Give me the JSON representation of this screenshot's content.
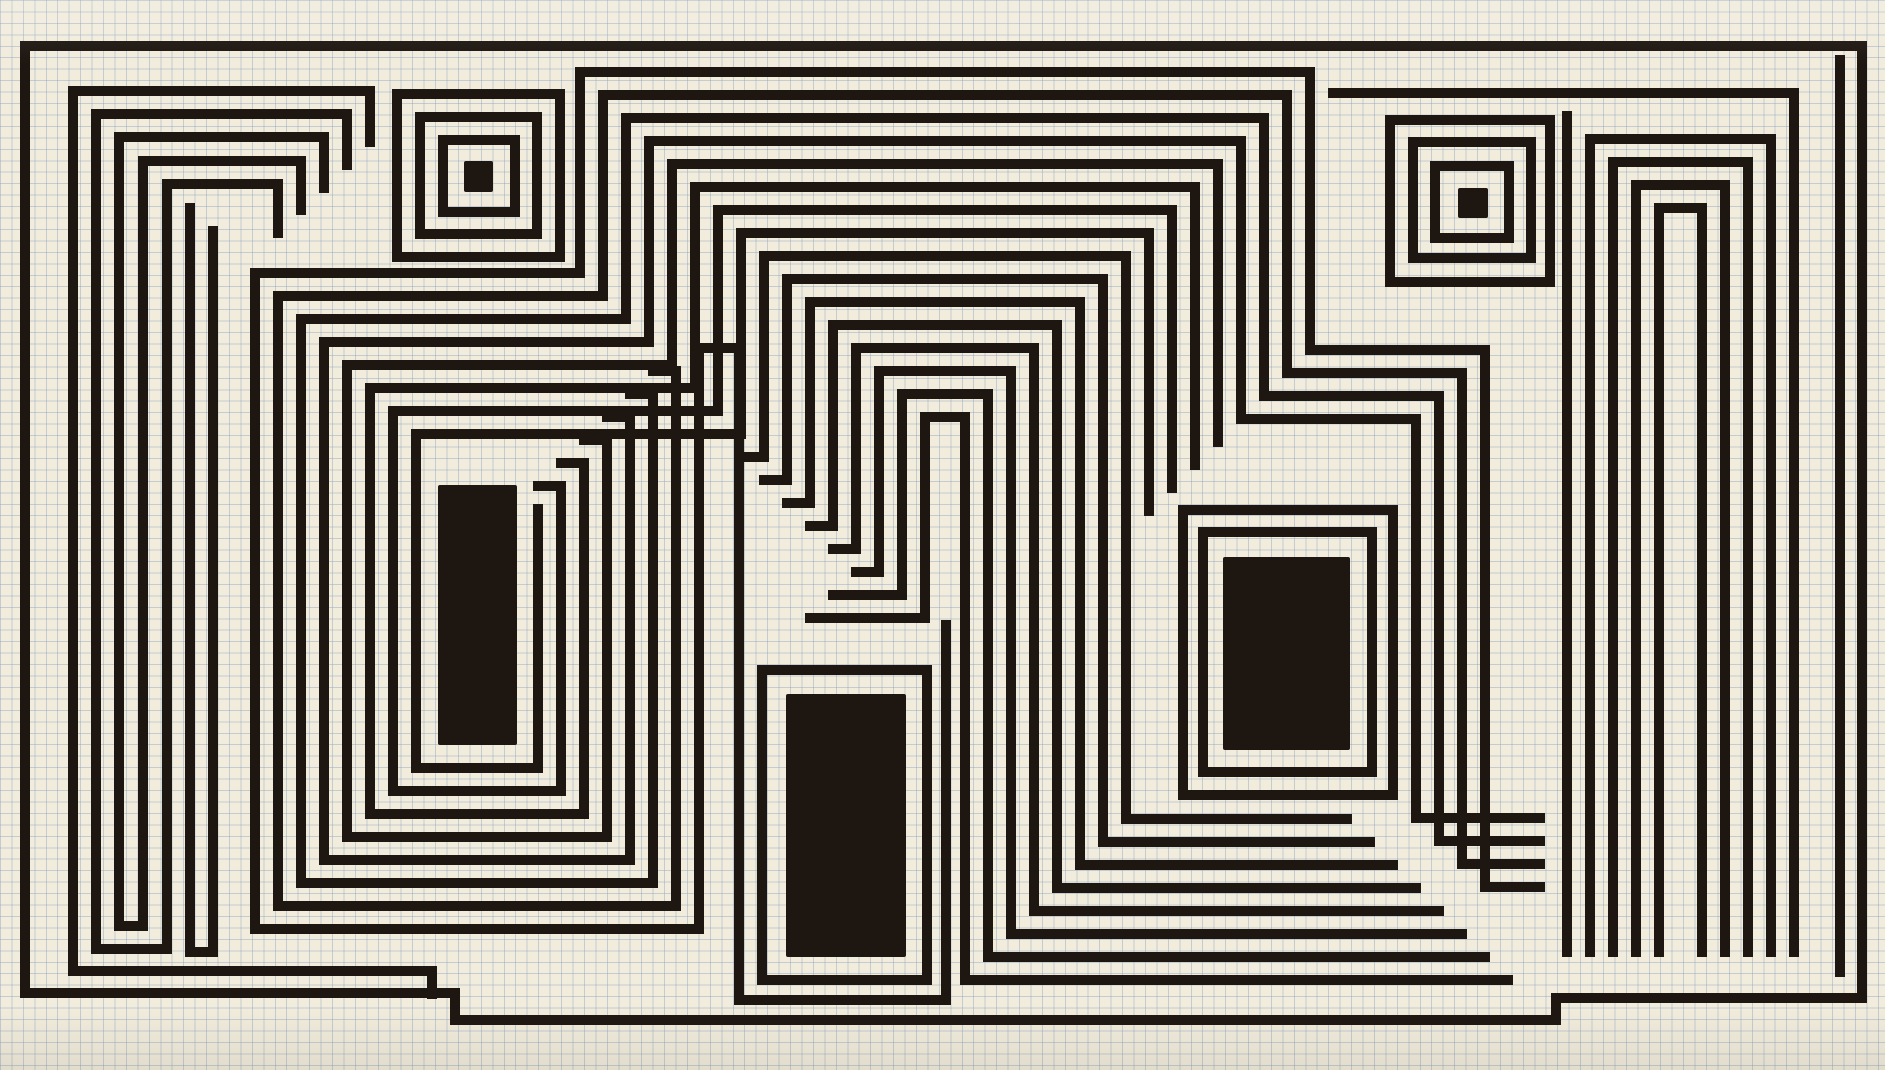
{
  "artwork": {
    "kind": "ink-labyrinth-drawing-on-graph-paper",
    "canvas": {
      "width": 1885,
      "height": 1070
    },
    "colors": {
      "paper": "#f1ecdc",
      "paper_edge": "#e3dcc9",
      "grid": "rgba(130,156,190,0.40)",
      "ink": "#1e1711"
    },
    "grid": {
      "cell": 11.45,
      "line": 1
    },
    "stroke_width": 10,
    "fills": [
      {
        "name": "left-black-rectangle",
        "x": 438,
        "y": 485,
        "w": 79,
        "h": 260
      },
      {
        "name": "center-black-rectangle",
        "x": 786,
        "y": 694,
        "w": 120,
        "h": 263
      },
      {
        "name": "right-black-rectangle",
        "x": 1223,
        "y": 557,
        "w": 127,
        "h": 193
      },
      {
        "name": "left-bullseye-core",
        "x": 464,
        "y": 161,
        "w": 29,
        "h": 31
      },
      {
        "name": "right-bullseye-core",
        "x": 1458,
        "y": 188,
        "w": 30,
        "h": 30
      }
    ],
    "rings": [
      {
        "name": "left-bullseye-ring-1",
        "x": 443,
        "y": 140,
        "w": 72,
        "h": 72
      },
      {
        "name": "left-bullseye-ring-2",
        "x": 420,
        "y": 117,
        "w": 117,
        "h": 117
      },
      {
        "name": "left-bullseye-ring-3",
        "x": 397,
        "y": 94,
        "w": 163,
        "h": 163
      },
      {
        "name": "right-bullseye-ring-1",
        "x": 1435,
        "y": 166,
        "w": 74,
        "h": 72
      },
      {
        "name": "right-bullseye-ring-2",
        "x": 1413,
        "y": 142,
        "w": 118,
        "h": 116
      },
      {
        "name": "right-bullseye-ring-3",
        "x": 1390,
        "y": 120,
        "w": 160,
        "h": 162
      },
      {
        "name": "center-rect-frame",
        "x": 762,
        "y": 670,
        "w": 165,
        "h": 310
      },
      {
        "name": "right-rect-frame-1",
        "x": 1203,
        "y": 532,
        "w": 169,
        "h": 240
      },
      {
        "name": "right-rect-frame-2",
        "x": 1183,
        "y": 510,
        "w": 210,
        "h": 285
      }
    ],
    "polylines": [
      {
        "name": "outer-border",
        "pts": [
          [
            25,
            46
          ],
          [
            1862,
            46
          ],
          [
            1862,
            998
          ],
          [
            1556,
            998
          ],
          [
            1556,
            1020
          ],
          [
            455,
            1020
          ],
          [
            455,
            993
          ],
          [
            25,
            993
          ],
          [
            25,
            46
          ]
        ]
      },
      {
        "name": "border-inner-right",
        "pts": [
          [
            1840,
            60
          ],
          [
            1840,
            972
          ]
        ]
      },
      {
        "name": "fan-line-1",
        "pts": [
          [
            370,
            142
          ],
          [
            370,
            91
          ],
          [
            73,
            91
          ],
          [
            73,
            971
          ],
          [
            432,
            971
          ],
          [
            432,
            994
          ]
        ]
      },
      {
        "name": "fan-line-2",
        "pts": [
          [
            347,
            165
          ],
          [
            347,
            114
          ],
          [
            96,
            114
          ],
          [
            96,
            949
          ],
          [
            167,
            949
          ],
          [
            167,
            184
          ],
          [
            278,
            184
          ],
          [
            278,
            233
          ]
        ]
      },
      {
        "name": "fan-line-3",
        "pts": [
          [
            324,
            188
          ],
          [
            324,
            137
          ],
          [
            119,
            137
          ],
          [
            119,
            926
          ],
          [
            143,
            926
          ],
          [
            143,
            161
          ],
          [
            301,
            161
          ],
          [
            301,
            210
          ]
        ]
      },
      {
        "name": "left-tall-u",
        "pts": [
          [
            190,
            208
          ],
          [
            190,
            952
          ],
          [
            213,
            952
          ],
          [
            213,
            231
          ]
        ]
      },
      {
        "name": "spiral-line-0",
        "pts": [
          [
            1540,
            887
          ],
          [
            1485,
            887
          ],
          [
            1485,
            350
          ],
          [
            1310,
            350
          ],
          [
            1310,
            72
          ],
          [
            580,
            72
          ],
          [
            580,
            273
          ],
          [
            255,
            273
          ],
          [
            255,
            929
          ],
          [
            699,
            929
          ],
          [
            699,
            348
          ],
          [
            739,
            348
          ],
          [
            739,
            1000
          ],
          [
            946,
            1000
          ],
          [
            946,
            625
          ]
        ]
      },
      {
        "name": "spiral-line-1",
        "pts": [
          [
            1540,
            864
          ],
          [
            1462,
            864
          ],
          [
            1462,
            373
          ],
          [
            1287,
            373
          ],
          [
            1287,
            95
          ],
          [
            603,
            95
          ],
          [
            603,
            296
          ],
          [
            278,
            296
          ],
          [
            278,
            906
          ],
          [
            676,
            906
          ],
          [
            676,
            371
          ],
          [
            653,
            371
          ]
        ]
      },
      {
        "name": "spiral-line-2",
        "pts": [
          [
            1540,
            841
          ],
          [
            1439,
            841
          ],
          [
            1439,
            396
          ],
          [
            1264,
            396
          ],
          [
            1264,
            118
          ],
          [
            626,
            118
          ],
          [
            626,
            319
          ],
          [
            301,
            319
          ],
          [
            301,
            883
          ],
          [
            653,
            883
          ],
          [
            653,
            394
          ],
          [
            630,
            394
          ]
        ]
      },
      {
        "name": "spiral-line-3",
        "pts": [
          [
            1540,
            818
          ],
          [
            1416,
            818
          ],
          [
            1416,
            419
          ],
          [
            1241,
            419
          ],
          [
            1241,
            141
          ],
          [
            649,
            141
          ],
          [
            649,
            342
          ],
          [
            324,
            342
          ],
          [
            324,
            860
          ],
          [
            630,
            860
          ],
          [
            630,
            417
          ],
          [
            607,
            417
          ]
        ]
      },
      {
        "name": "spiral-line-4",
        "pts": [
          [
            1218,
            442
          ],
          [
            1218,
            164
          ],
          [
            672,
            164
          ],
          [
            672,
            365
          ],
          [
            347,
            365
          ],
          [
            347,
            837
          ],
          [
            607,
            837
          ],
          [
            607,
            440
          ],
          [
            584,
            440
          ]
        ]
      },
      {
        "name": "spiral-line-5",
        "pts": [
          [
            1195,
            465
          ],
          [
            1195,
            187
          ],
          [
            695,
            187
          ],
          [
            695,
            388
          ],
          [
            370,
            388
          ],
          [
            370,
            814
          ],
          [
            584,
            814
          ],
          [
            584,
            463
          ],
          [
            561,
            463
          ]
        ]
      },
      {
        "name": "spiral-line-6",
        "pts": [
          [
            1172,
            488
          ],
          [
            1172,
            210
          ],
          [
            718,
            210
          ],
          [
            718,
            411
          ],
          [
            393,
            411
          ],
          [
            393,
            791
          ],
          [
            561,
            791
          ],
          [
            561,
            486
          ],
          [
            538,
            486
          ]
        ]
      },
      {
        "name": "spiral-line-7",
        "pts": [
          [
            1149,
            511
          ],
          [
            1149,
            233
          ],
          [
            741,
            233
          ],
          [
            741,
            434
          ],
          [
            416,
            434
          ],
          [
            416,
            768
          ],
          [
            538,
            768
          ],
          [
            538,
            509
          ]
        ]
      },
      {
        "name": "spiral-line-8",
        "pts": [
          [
            1347,
            819
          ],
          [
            1126,
            819
          ],
          [
            1126,
            256
          ],
          [
            764,
            256
          ],
          [
            764,
            457
          ],
          [
            741,
            457
          ]
        ]
      },
      {
        "name": "spiral-line-9",
        "pts": [
          [
            1370,
            842
          ],
          [
            1103,
            842
          ],
          [
            1103,
            279
          ],
          [
            787,
            279
          ],
          [
            787,
            480
          ],
          [
            764,
            480
          ]
        ]
      },
      {
        "name": "spiral-line-10",
        "pts": [
          [
            1393,
            865
          ],
          [
            1080,
            865
          ],
          [
            1080,
            302
          ],
          [
            810,
            302
          ],
          [
            810,
            503
          ],
          [
            787,
            503
          ]
        ]
      },
      {
        "name": "spiral-line-11",
        "pts": [
          [
            1416,
            888
          ],
          [
            1057,
            888
          ],
          [
            1057,
            325
          ],
          [
            833,
            325
          ],
          [
            833,
            526
          ],
          [
            810,
            526
          ]
        ]
      },
      {
        "name": "spiral-line-12",
        "pts": [
          [
            1439,
            911
          ],
          [
            1034,
            911
          ],
          [
            1034,
            348
          ],
          [
            856,
            348
          ],
          [
            856,
            549
          ],
          [
            833,
            549
          ]
        ]
      },
      {
        "name": "center-hairpin-1",
        "pts": [
          [
            1462,
            934
          ],
          [
            1011,
            934
          ],
          [
            1011,
            371
          ],
          [
            879,
            371
          ],
          [
            879,
            572
          ],
          [
            856,
            572
          ]
        ]
      },
      {
        "name": "center-hairpin-2",
        "pts": [
          [
            1485,
            957
          ],
          [
            988,
            957
          ],
          [
            988,
            394
          ],
          [
            902,
            394
          ],
          [
            902,
            595
          ],
          [
            833,
            595
          ]
        ]
      },
      {
        "name": "center-hairpin-3",
        "pts": [
          [
            1508,
            980
          ],
          [
            965,
            980
          ],
          [
            965,
            417
          ],
          [
            925,
            417
          ],
          [
            925,
            618
          ],
          [
            810,
            618
          ]
        ]
      },
      {
        "name": "right-comb-top",
        "pts": [
          [
            1333,
            93
          ],
          [
            1794,
            93
          ],
          [
            1794,
            952
          ]
        ]
      },
      {
        "name": "right-comb-v",
        "pts": [
          [
            1567,
            116
          ],
          [
            1567,
            952
          ]
        ]
      },
      {
        "name": "right-comb-1",
        "pts": [
          [
            1590,
            952
          ],
          [
            1590,
            139
          ],
          [
            1771,
            139
          ],
          [
            1771,
            952
          ]
        ]
      },
      {
        "name": "right-comb-2",
        "pts": [
          [
            1613,
            952
          ],
          [
            1613,
            162
          ],
          [
            1748,
            162
          ],
          [
            1748,
            952
          ]
        ]
      },
      {
        "name": "right-comb-3",
        "pts": [
          [
            1636,
            952
          ],
          [
            1636,
            185
          ],
          [
            1725,
            185
          ],
          [
            1725,
            952
          ]
        ]
      },
      {
        "name": "right-comb-4",
        "pts": [
          [
            1659,
            952
          ],
          [
            1659,
            208
          ],
          [
            1702,
            208
          ],
          [
            1702,
            952
          ]
        ]
      }
    ]
  }
}
